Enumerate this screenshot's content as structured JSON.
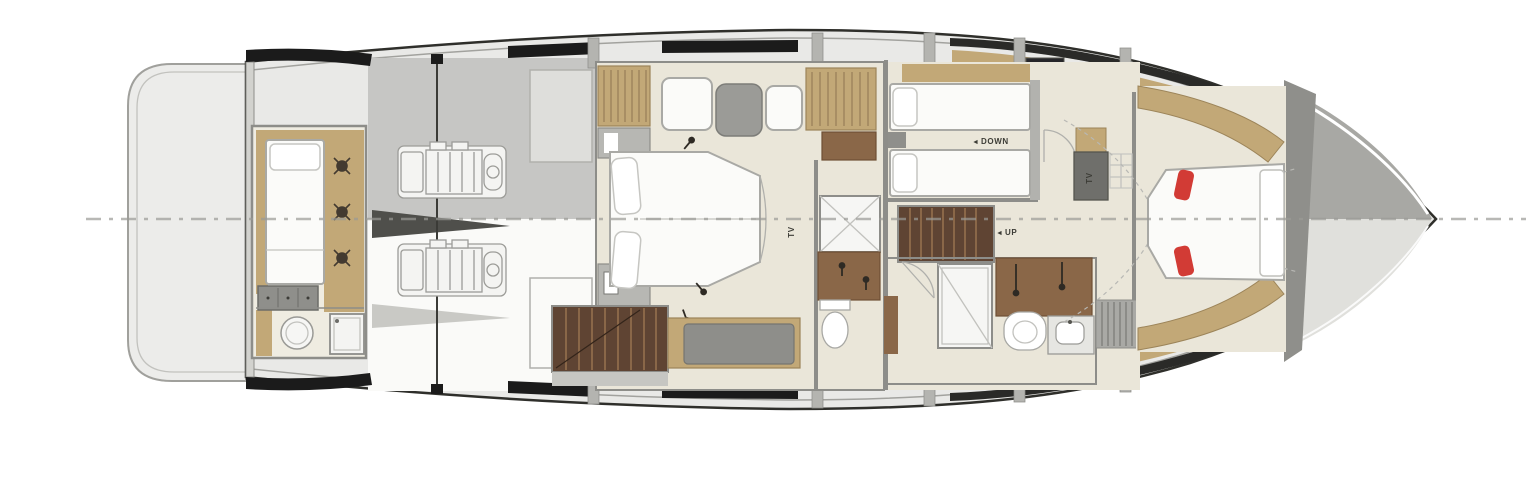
{
  "labels": {
    "down": "DOWN",
    "up": "UP",
    "tv_master": "TV",
    "tv_landing": "TV",
    "arrow_left": "◄"
  },
  "colors": {
    "hull-deck": "#e9e9e7",
    "floor-cream": "#eae6d9",
    "wood-tan": "#c2a877",
    "wood-brown": "#8a6748",
    "stair-brown": "#5f4433",
    "wall-gray": "#8d8d89",
    "band-black": "#1b1b1b",
    "bed-white": "#fbfbf9",
    "accent-red": "#d23b35",
    "centerline-gray": "#9a9a96"
  }
}
